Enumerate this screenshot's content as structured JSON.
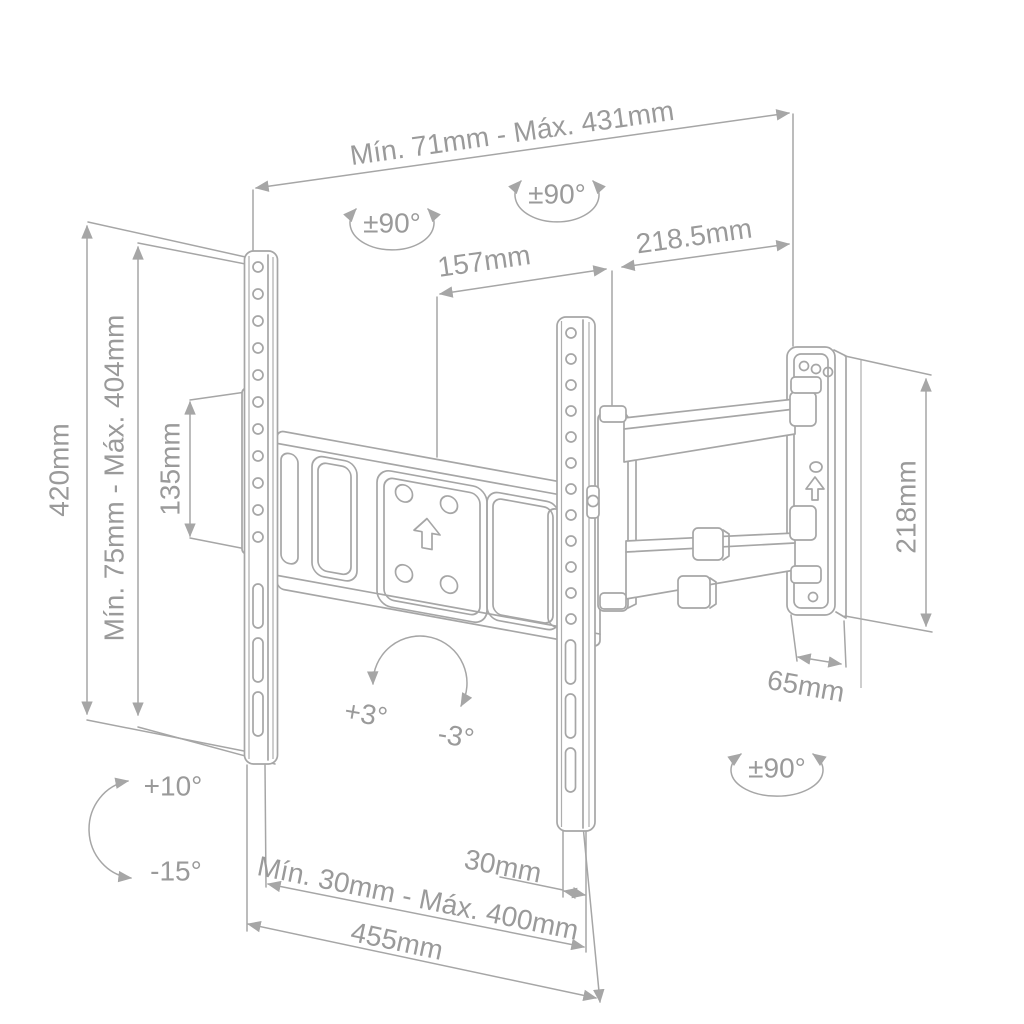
{
  "colors": {
    "line": "#a6a6a6",
    "text": "#9a9a9a",
    "background": "#ffffff"
  },
  "labels": {
    "span_top": "Mín. 71mm - Máx. 431mm",
    "swivel_left": "±90°",
    "swivel_center": "±90°",
    "swivel_wall": "±90°",
    "dim_157": "157mm",
    "dim_2185": "218.5mm",
    "dim_420": "420mm",
    "span_left": "Mín. 75mm - Máx. 404mm",
    "dim_135": "135mm",
    "dim_218": "218mm",
    "dim_65": "65mm",
    "rotate_plus3": "+3°",
    "rotate_minus3": "-3°",
    "tilt_plus10": "+10°",
    "tilt_minus15": "-15°",
    "dim_30": "30mm",
    "span_bottom": "Mín. 30mm - Máx. 400mm",
    "dim_455": "455mm"
  }
}
